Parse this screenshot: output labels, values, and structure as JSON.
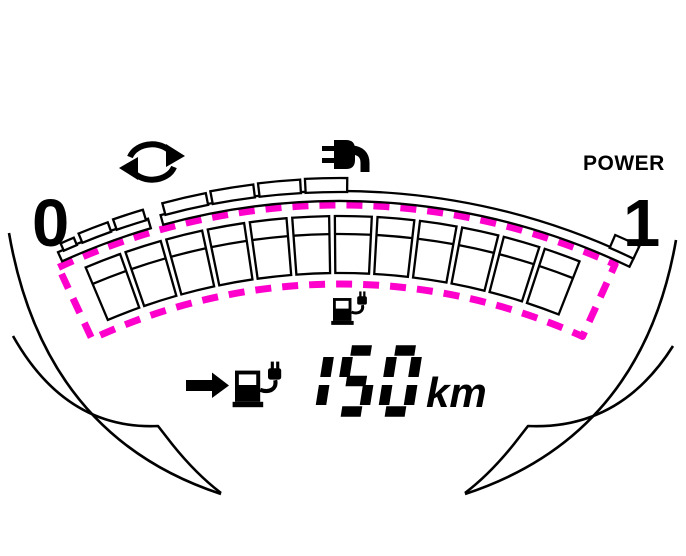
{
  "labels": {
    "gauge_min": "0",
    "gauge_max": "1",
    "power": "POWER",
    "range_unit": "km"
  },
  "display": {
    "range_value": "150",
    "seven_segment_map": {
      "1": "bc",
      "5": "afgcd",
      "0": "abcdef"
    }
  },
  "colors": {
    "ink": "#000000",
    "highlight": "#FF00CC",
    "background": "#ffffff"
  },
  "icons": {
    "regen_arrows": "circular-chasing-arrows",
    "charging_plug": "power-plug-with-cord",
    "charging_station": "charge-station-with-plug",
    "right_arrow": "solid-right-arrow"
  },
  "gauge": {
    "scale_min": "0",
    "scale_max": "1",
    "center": {
      "x": 340,
      "y": 871
    },
    "segments": {
      "count": 12,
      "start_deg": -23.1,
      "end_deg": 21.7,
      "gap_deg": 0.5,
      "outer_r": 655,
      "inner_r": 598,
      "divider_r": 637
    },
    "rail": {
      "outer_r": 680,
      "inner_r": 670,
      "pieces": [
        [
          -24.5,
          -16.4
        ],
        [
          -15.3,
          25.6
        ]
      ]
    },
    "ticks": [
      {
        "start": -24.0,
        "end": -22.8,
        "h": 7
      },
      {
        "start": -22.3,
        "end": -19.7,
        "h": 9
      },
      {
        "start": -19.2,
        "end": -16.6,
        "h": 10
      },
      {
        "start": -14.9,
        "end": -11.2,
        "h": 11
      },
      {
        "start": -10.8,
        "end": -7.2,
        "h": 12
      },
      {
        "start": -6.8,
        "end": -3.3,
        "h": 12.5
      },
      {
        "start": -2.9,
        "end": 0.6,
        "h": 13
      }
    ],
    "end_box": {
      "start": 23.4,
      "end": 25.6,
      "h": 13
    },
    "dashed_outline": {
      "outer_r": 666,
      "inner_r": 587,
      "start_deg": -25.0,
      "end_deg": 24.4,
      "stroke_width": 7,
      "dash": "16 11"
    }
  }
}
